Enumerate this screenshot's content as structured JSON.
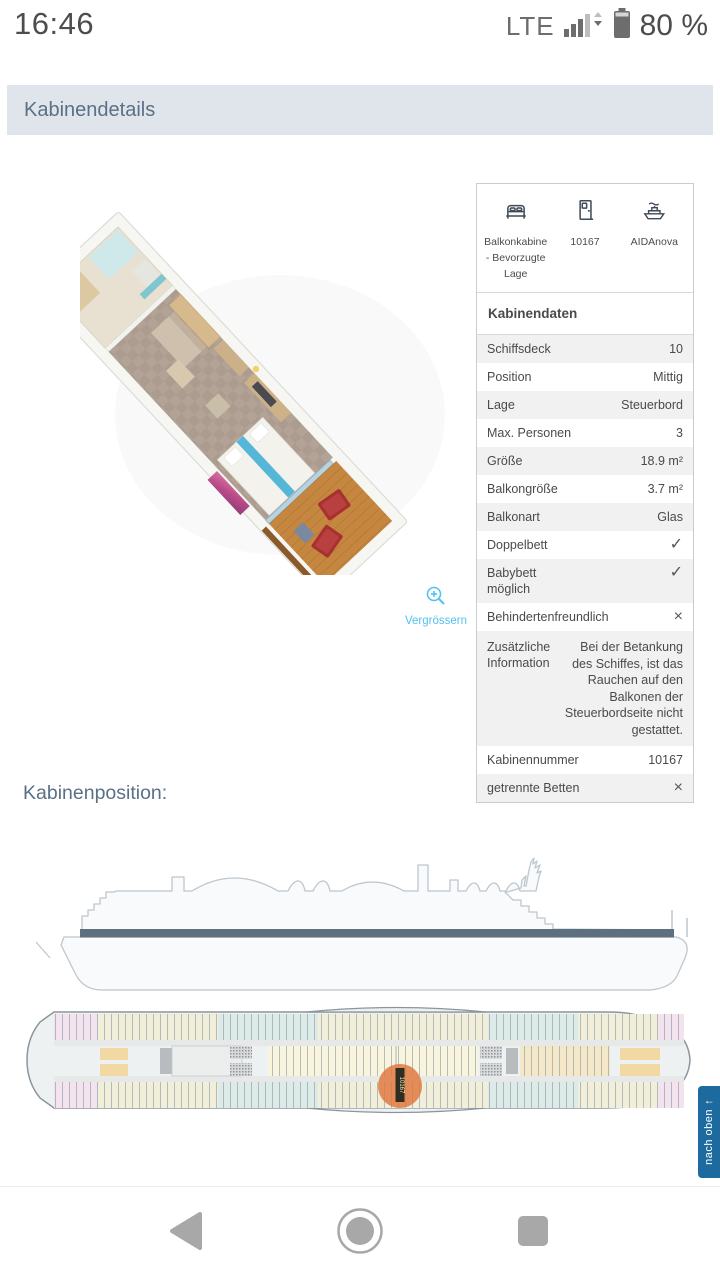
{
  "status_bar": {
    "time": "16:46",
    "network_label": "LTE",
    "battery_percent": "80 %"
  },
  "header": {
    "title": "Kabinendetails"
  },
  "figure": {
    "zoom_label": "Vergrössern"
  },
  "info_card": {
    "summary": [
      {
        "icon": "bed-icon",
        "label": "Balkonkabine - Bevorzugte Lage"
      },
      {
        "icon": "door-icon",
        "label": "10167"
      },
      {
        "icon": "ship-icon",
        "label": "AIDAnova"
      }
    ],
    "section_title": "Kabinendaten",
    "rows": [
      {
        "label": "Schiffsdeck",
        "value": "10"
      },
      {
        "label": "Position",
        "value": "Mittig"
      },
      {
        "label": "Lage",
        "value": "Steuerbord"
      },
      {
        "label": "Max. Personen",
        "value": "3"
      },
      {
        "label": "Größe",
        "value": "18.9 m²"
      },
      {
        "label": "Balkongröße",
        "value": "3.7 m²"
      },
      {
        "label": "Balkonart",
        "value": "Glas"
      },
      {
        "label": "Doppelbett",
        "value": "✓"
      },
      {
        "label": "Babybett möglich",
        "value": "✓"
      },
      {
        "label": "Behindertenfreundlich",
        "value": "×"
      },
      {
        "label": "Zusätzliche Information",
        "value": "Bei der Betankung des Schiffes, ist das Rauchen auf den Balkonen der Steuerbordseite nicht gestattet."
      },
      {
        "label": "Kabinennummer",
        "value": "10167"
      },
      {
        "label": "getrennte Betten",
        "value": "×"
      }
    ]
  },
  "position_section": {
    "title": "Kabinenposition:",
    "marker_label": "10167"
  },
  "back_to_top": {
    "label": "nach oben",
    "arrow": "↑"
  },
  "colors": {
    "accent_blue": "#53c2ef",
    "header_bg": "#dfe5ea",
    "header_text": "#5a7086",
    "marker_orange": "#e0763c",
    "deck_band": "#5c7080",
    "row_alt_bg": "#f1f1f1"
  }
}
